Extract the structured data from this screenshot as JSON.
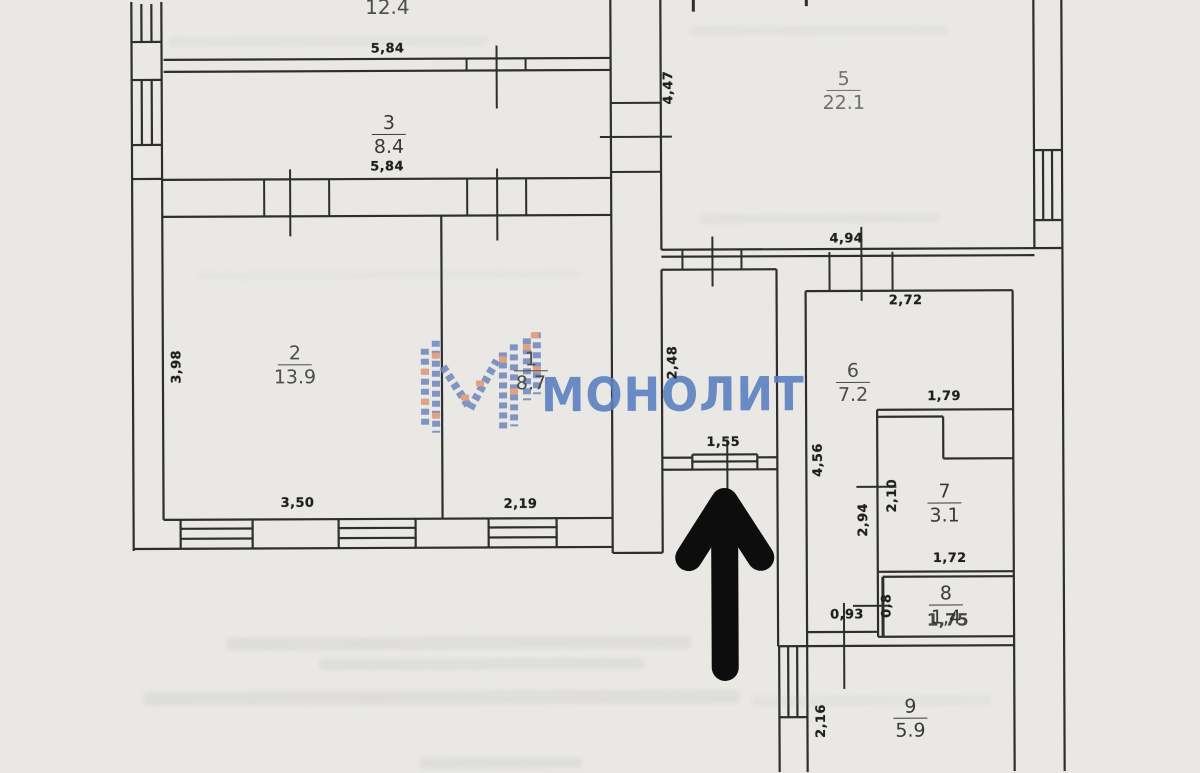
{
  "page": {
    "background": "#e9e8e5"
  },
  "watermark": {
    "brand_text": "МОНОЛИТ",
    "blue": "#5d80c1",
    "orange": "#e29873"
  },
  "entrance_arrow": {
    "direction": "up",
    "color": "#0d0d0d"
  },
  "rooms": [
    {
      "number": "",
      "area": "12.4"
    },
    {
      "number": "3",
      "area": "8.4"
    },
    {
      "number": "5",
      "area": "22.1"
    },
    {
      "number": "2",
      "area": "13.9"
    },
    {
      "number": "1",
      "area": "8.7"
    },
    {
      "number": "6",
      "area": "7.2"
    },
    {
      "number": "7",
      "area": "3.1"
    },
    {
      "number": "8",
      "area": "1,4",
      "width_label": "1,75"
    },
    {
      "number": "9",
      "area": "5.9"
    }
  ],
  "dimensions": [
    {
      "value": "5,84"
    },
    {
      "value": "5,84"
    },
    {
      "value": "4,47"
    },
    {
      "value": "4,94"
    },
    {
      "value": "3,98"
    },
    {
      "value": "3,50"
    },
    {
      "value": "2,19"
    },
    {
      "value": "2,48"
    },
    {
      "value": "1,55"
    },
    {
      "value": "2,72"
    },
    {
      "value": "4,56"
    },
    {
      "value": "1,79"
    },
    {
      "value": "2,10"
    },
    {
      "value": "2,94"
    },
    {
      "value": "1,72"
    },
    {
      "value": "0,8"
    },
    {
      "value": "0,93"
    },
    {
      "value": "2,16"
    }
  ]
}
